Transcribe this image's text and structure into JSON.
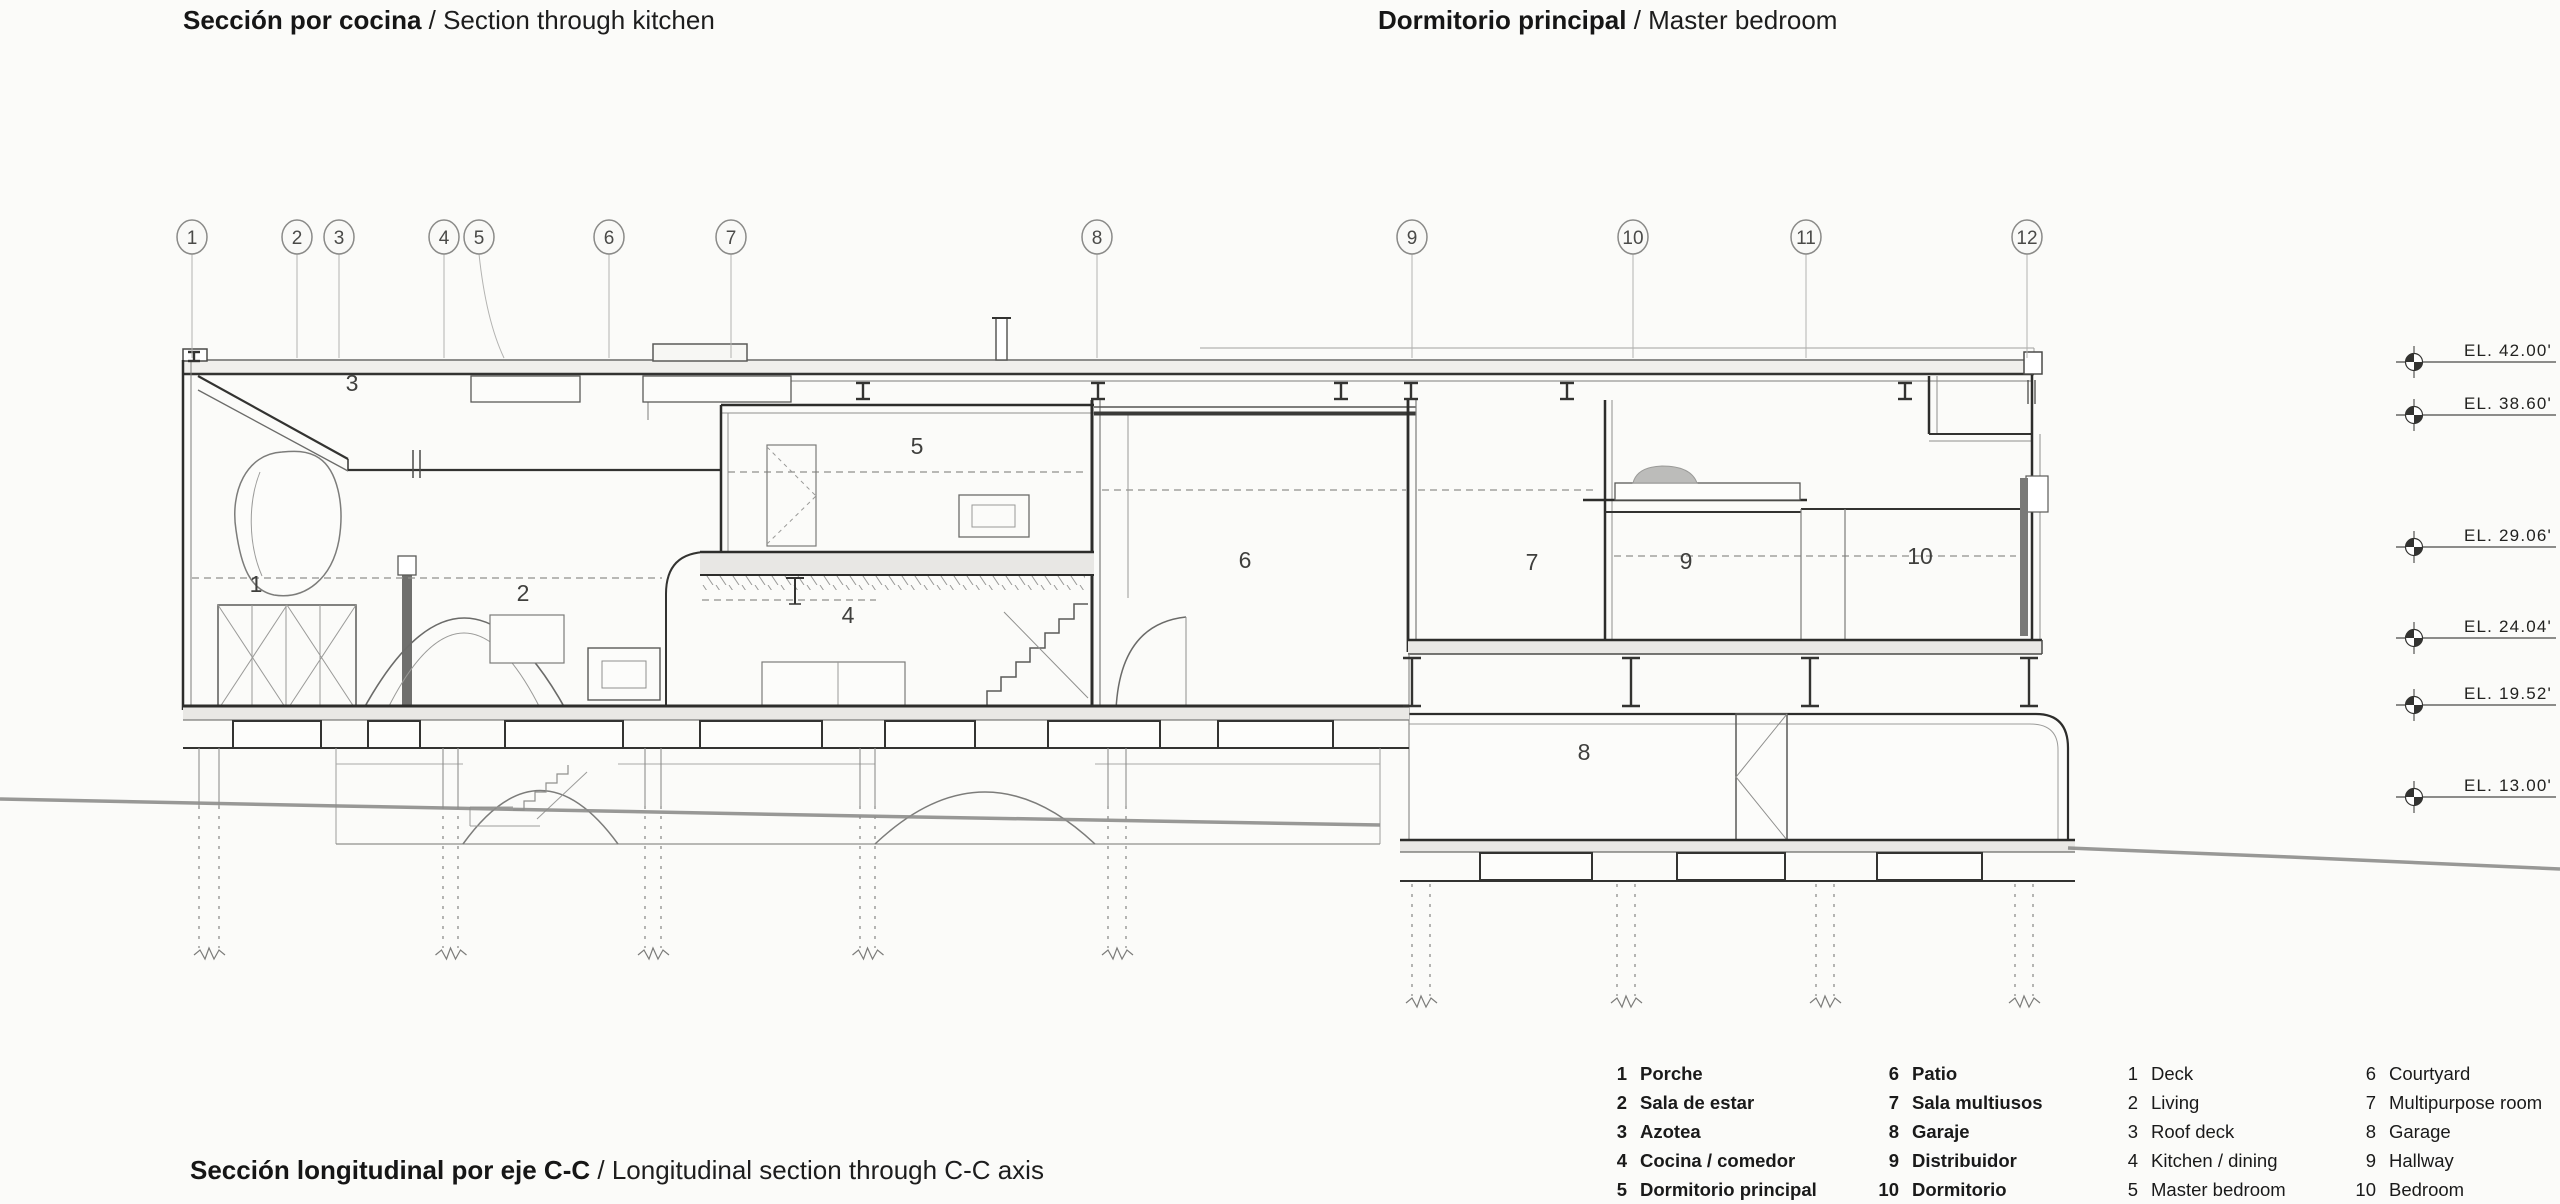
{
  "titles": {
    "top_left": {
      "bold": "Sección por cocina",
      "regular": " / Section through kitchen"
    },
    "top_right": {
      "bold": "Dormitorio principal",
      "regular": " / Master bedroom"
    },
    "bottom": {
      "bold": "Sección longitudinal por eje C-C",
      "regular": " / Longitudinal section through C-C axis"
    }
  },
  "grid_bubbles": [
    {
      "label": "1",
      "x": 192
    },
    {
      "label": "2",
      "x": 297
    },
    {
      "label": "3",
      "x": 339
    },
    {
      "label": "4",
      "x": 444
    },
    {
      "label": "5",
      "x": 479
    },
    {
      "label": "6",
      "x": 609
    },
    {
      "label": "7",
      "x": 731
    },
    {
      "label": "8",
      "x": 1097
    },
    {
      "label": "9",
      "x": 1412
    },
    {
      "label": "10",
      "x": 1633
    },
    {
      "label": "11",
      "x": 1806
    },
    {
      "label": "12",
      "x": 2027
    }
  ],
  "elevation_markers": [
    {
      "label": "EL. 42.00'",
      "y": 362
    },
    {
      "label": "EL. 38.60'",
      "y": 415
    },
    {
      "label": "EL. 29.06'",
      "y": 547
    },
    {
      "label": "EL. 24.04'",
      "y": 638
    },
    {
      "label": "EL. 19.52'",
      "y": 705
    },
    {
      "label": "EL. 13.00'",
      "y": 797
    }
  ],
  "room_markers": [
    {
      "label": "1",
      "x": 256,
      "y": 592
    },
    {
      "label": "2",
      "x": 523,
      "y": 601
    },
    {
      "label": "3",
      "x": 352,
      "y": 391
    },
    {
      "label": "4",
      "x": 848,
      "y": 623
    },
    {
      "label": "5",
      "x": 917,
      "y": 454
    },
    {
      "label": "6",
      "x": 1245,
      "y": 568
    },
    {
      "label": "7",
      "x": 1532,
      "y": 570
    },
    {
      "label": "8",
      "x": 1584,
      "y": 760
    },
    {
      "label": "9",
      "x": 1686,
      "y": 569
    },
    {
      "label": "10",
      "x": 1920,
      "y": 564
    }
  ],
  "legend": {
    "columns": [
      {
        "lang": "es",
        "bold": true,
        "items": [
          {
            "num": "1",
            "label": "Porche"
          },
          {
            "num": "2",
            "label": "Sala de estar"
          },
          {
            "num": "3",
            "label": "Azotea"
          },
          {
            "num": "4",
            "label": "Cocina / comedor"
          },
          {
            "num": "5",
            "label": "Dormitorio principal"
          }
        ]
      },
      {
        "lang": "es",
        "bold": true,
        "items": [
          {
            "num": "6",
            "label": "Patio"
          },
          {
            "num": "7",
            "label": "Sala multiusos"
          },
          {
            "num": "8",
            "label": "Garaje"
          },
          {
            "num": "9",
            "label": "Distribuidor"
          },
          {
            "num": "10",
            "label": "Dormitorio"
          }
        ]
      },
      {
        "lang": "en",
        "bold": false,
        "items": [
          {
            "num": "1",
            "label": "Deck"
          },
          {
            "num": "2",
            "label": "Living"
          },
          {
            "num": "3",
            "label": "Roof deck"
          },
          {
            "num": "4",
            "label": "Kitchen / dining"
          },
          {
            "num": "5",
            "label": "Master bedroom"
          }
        ]
      },
      {
        "lang": "en",
        "bold": false,
        "items": [
          {
            "num": "6",
            "label": "Courtyard"
          },
          {
            "num": "7",
            "label": "Multipurpose room"
          },
          {
            "num": "8",
            "label": "Garage"
          },
          {
            "num": "9",
            "label": "Hallway"
          },
          {
            "num": "10",
            "label": "Bedroom"
          }
        ]
      }
    ]
  }
}
